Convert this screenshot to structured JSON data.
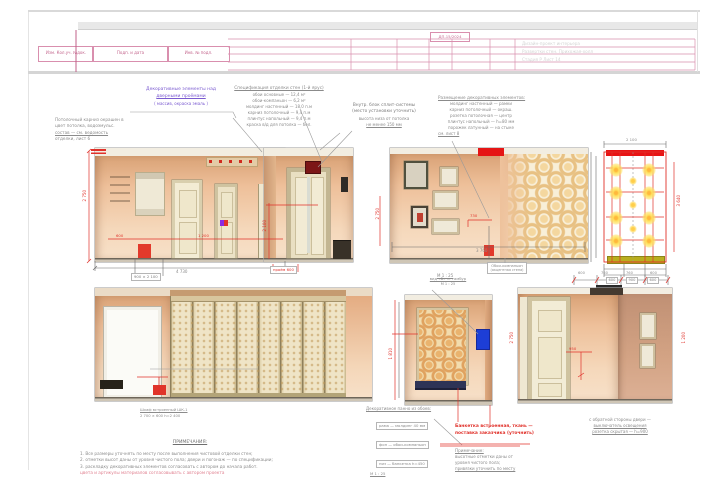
{
  "colors": {
    "accent_red": "#e0312a",
    "stamp_pink": "#c4678e",
    "annotation_purple": "#7a5ad0",
    "wall_peach": "#eec09a",
    "wallpaper_gold": "#e8c183",
    "bench_navy": "#2e3356",
    "intercom_blue": "#1d3ed6",
    "light_yellow": "#ffe15e"
  },
  "title_block": {
    "code_label": "ДП-15/2024",
    "stamp_cells": [
      "Изм. Кол.уч. №док.",
      "Подп. и дата",
      "Инв. № подл."
    ],
    "ghost_rows": [
      "Дизайн-проект интерьера",
      "Развертки стен. Прихожая-холл",
      "Стадия  Р    Лист 14"
    ]
  },
  "annotations": {
    "purple_note": {
      "line1": "Декоративные элементы над",
      "line2": "дверными проёмами",
      "line3": "( массив, окраска эмаль )"
    },
    "block_a": {
      "title": "Спецификация отделки стен (1-й ярус)",
      "rows": [
        "обои основные — 12,4 м²",
        "обои-компаньон — 6,2 м²",
        "молдинг настенный — 18,0 п.м",
        "карниз потолочный — 9,4 п.м",
        "плинтус напольный — 9,4 п.м",
        "краска в/д для потолка — бел."
      ]
    },
    "block_b": {
      "title1": "Внутр. блок сплит-системы",
      "title2": "(место установки уточнить)",
      "row1": "высота низа от потолка",
      "row2": "не менее 150 мм"
    },
    "block_c": {
      "title": "Размещение декоративных элементов:",
      "rows": [
        "молдинг настенный — рамки",
        "карниз потолочный — окраш.",
        "розетка потолочная — центр",
        "плинтус напольный — h=80 мм",
        "порожек латунный — на стыке"
      ],
      "footer": "см. лист 8"
    },
    "block_d": {
      "rows": [
        "Потолочный карниз окрашен в",
        "цвет потолка, водоэмульс.",
        "состав — см. ведомость",
        "отделки, лист 6"
      ]
    }
  },
  "elevation_labels": {
    "elev3_box": {
      "line1": "Обои-компаньон",
      "line2": "(акцентная стена)"
    },
    "elev3_scale": "М 1 : 25",
    "elev4_note": {
      "line1": "Шкаф встроенный ШК-1",
      "line2": "2 700 × 600 h=2 400"
    },
    "elev5_top": {
      "line1": "вид «Б» — тамбур",
      "line2": "М 1 : 25"
    },
    "elev5_block": {
      "title": "Декоративное панно из обоев:",
      "rows": [
        "рама — молдинг 40 мм",
        "фон — обои-компаньон",
        "низ — банкетка h=450"
      ],
      "footer": "М 1 : 25"
    },
    "red_note": {
      "line1": "Банкетка встроенная, ткань —",
      "line2": "поставка заказчика (уточнить)"
    },
    "elev5_gray": {
      "title": "Примечание:",
      "rows": [
        "высотные отметки даны от",
        "уровня чистого пола;",
        "привязки уточнить по месту"
      ]
    },
    "elev6_note": {
      "rows": [
        "с обратной стороны двери —",
        "выключатель освещения",
        "розетка скрытая — h=900"
      ]
    }
  },
  "notes": {
    "title": "ПРИМЕЧАНИЯ:",
    "lines": [
      "1. Все размеры уточнять по месту после выполнения чистовой отделки стен;",
      "2. отметки высот даны от уровня чистого пола; двери и погонаж — по спецификации;",
      "3. раскладку декоративных элементов согласовать с автором до начала работ."
    ],
    "red_line": "цвета и артикулы материалов согласовывать с автором проекта"
  },
  "dimensions": {
    "elev1_height": "2 750",
    "elev1_width": "4 730",
    "elev1_red_a": "600",
    "elev1_red_b": "1 200",
    "elev1_door_box": "900 × 2 100",
    "elev2_opening": "проём 600",
    "elev2_red_v": "2 100",
    "elev3_red": "730",
    "elev3_width": "3 760",
    "plan_top": "2 100",
    "plan_right": "3 640",
    "plan_cells": [
      "600",
      "900",
      "600"
    ],
    "elev5_red_v": "1 810",
    "elev6_red": "950",
    "elev6_height": "2 750",
    "elev6_right": "1 200",
    "elev6_dims": [
      "600",
      "760",
      "760",
      "600"
    ]
  }
}
